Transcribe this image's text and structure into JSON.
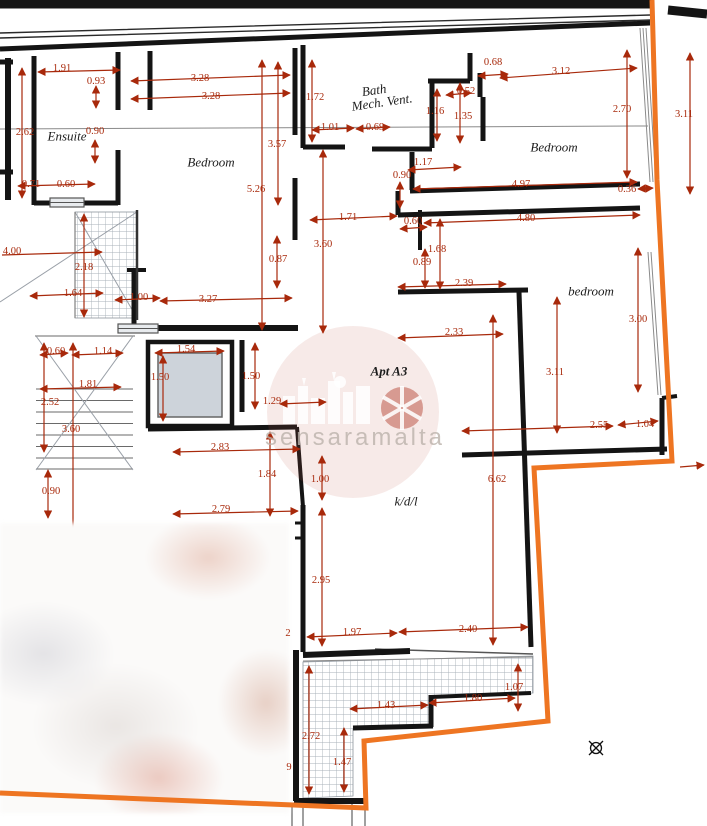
{
  "plan": {
    "apartment_label": "Apt A3",
    "watermark_text": "sensaramalta",
    "colors": {
      "dimension": "#a8290b",
      "boundary": "#ee7522",
      "wall": "#141414",
      "hatch": "#a9b0b8"
    }
  },
  "rooms": [
    {
      "id": "ensuite",
      "label": "Ensuite",
      "x": 67,
      "y": 136,
      "rot": 0
    },
    {
      "id": "bedroom-top-left",
      "label": "Bedroom",
      "x": 211,
      "y": 162,
      "rot": 0
    },
    {
      "id": "bath",
      "label": "Bath",
      "x": 374,
      "y": 90,
      "rot": -8
    },
    {
      "id": "bath-mech-vent",
      "label": "Mech. Vent.",
      "x": 382,
      "y": 102,
      "rot": -8
    },
    {
      "id": "bedroom-top-right",
      "label": "Bedroom",
      "x": 554,
      "y": 147,
      "rot": 0
    },
    {
      "id": "bedroom-right",
      "label": "bedroom",
      "x": 591,
      "y": 291,
      "rot": 0
    },
    {
      "id": "apartment",
      "label": "Apt A3",
      "x": 389,
      "y": 371,
      "rot": 0,
      "bold": true
    },
    {
      "id": "kdl",
      "label": "k/d/l",
      "x": 406,
      "y": 501,
      "rot": 0
    }
  ],
  "dimensions": [
    {
      "v": "1.91",
      "x": 62,
      "y": 69
    },
    {
      "v": "0.93",
      "x": 96,
      "y": 82
    },
    {
      "v": "2.62",
      "x": 25,
      "y": 133
    },
    {
      "v": "0.90",
      "x": 95,
      "y": 132
    },
    {
      "v": "0.71",
      "x": 31,
      "y": 185
    },
    {
      "v": "0.60",
      "x": 66,
      "y": 185
    },
    {
      "v": "4.00",
      "x": 12,
      "y": 252
    },
    {
      "v": "2.18",
      "x": 84,
      "y": 268
    },
    {
      "v": "1.64",
      "x": 73,
      "y": 294
    },
    {
      "v": "1.00",
      "x": 139,
      "y": 298
    },
    {
      "v": "3.27",
      "x": 208,
      "y": 300
    },
    {
      "v": "3.28",
      "x": 200,
      "y": 79
    },
    {
      "v": "3.28",
      "x": 211,
      "y": 97
    },
    {
      "v": "3.57",
      "x": 277,
      "y": 145
    },
    {
      "v": "5.26",
      "x": 256,
      "y": 190
    },
    {
      "v": "0.87",
      "x": 278,
      "y": 260
    },
    {
      "v": "1.71",
      "x": 348,
      "y": 218
    },
    {
      "v": "3.60",
      "x": 323,
      "y": 245
    },
    {
      "v": "1.72",
      "x": 315,
      "y": 98
    },
    {
      "v": "1.01",
      "x": 330,
      "y": 128
    },
    {
      "v": "0.69",
      "x": 375,
      "y": 128
    },
    {
      "v": "1.16",
      "x": 435,
      "y": 112
    },
    {
      "v": "1.35",
      "x": 463,
      "y": 117
    },
    {
      "v": "0.52",
      "x": 466,
      "y": 92
    },
    {
      "v": "0.68",
      "x": 493,
      "y": 63
    },
    {
      "v": "1.17",
      "x": 423,
      "y": 163
    },
    {
      "v": "0.90",
      "x": 402,
      "y": 176
    },
    {
      "v": "3.12",
      "x": 561,
      "y": 72
    },
    {
      "v": "2.70",
      "x": 622,
      "y": 110
    },
    {
      "v": "3.11",
      "x": 684,
      "y": 115
    },
    {
      "v": "4.97",
      "x": 521,
      "y": 185
    },
    {
      "v": "0.36",
      "x": 627,
      "y": 190
    },
    {
      "v": "4.80",
      "x": 526,
      "y": 219
    },
    {
      "v": "0.60",
      "x": 413,
      "y": 222
    },
    {
      "v": "1.68",
      "x": 437,
      "y": 250
    },
    {
      "v": "0.89",
      "x": 422,
      "y": 263
    },
    {
      "v": "2.39",
      "x": 464,
      "y": 284
    },
    {
      "v": "3.00",
      "x": 638,
      "y": 320
    },
    {
      "v": "2.33",
      "x": 454,
      "y": 333
    },
    {
      "v": "3.11",
      "x": 555,
      "y": 373
    },
    {
      "v": "2.55",
      "x": 599,
      "y": 426
    },
    {
      "v": "1.04",
      "x": 645,
      "y": 425
    },
    {
      "v": "6.62",
      "x": 497,
      "y": 480
    },
    {
      "v": "0.60",
      "x": 56,
      "y": 352
    },
    {
      "v": "1.14",
      "x": 103,
      "y": 352
    },
    {
      "v": "1.54",
      "x": 186,
      "y": 350
    },
    {
      "v": "1.81",
      "x": 88,
      "y": 385
    },
    {
      "v": "1.50",
      "x": 160,
      "y": 378
    },
    {
      "v": "1.50",
      "x": 251,
      "y": 377
    },
    {
      "v": "2.52",
      "x": 50,
      "y": 403
    },
    {
      "v": "1.29",
      "x": 272,
      "y": 402
    },
    {
      "v": "3.60",
      "x": 71,
      "y": 430
    },
    {
      "v": "2.83",
      "x": 220,
      "y": 448
    },
    {
      "v": "1.84",
      "x": 267,
      "y": 475
    },
    {
      "v": "0.90",
      "x": 51,
      "y": 492
    },
    {
      "v": "2.79",
      "x": 221,
      "y": 510
    },
    {
      "v": "1.00",
      "x": 320,
      "y": 480
    },
    {
      "v": "2.95",
      "x": 321,
      "y": 581
    },
    {
      "v": "1.97",
      "x": 352,
      "y": 633
    },
    {
      "v": "2.40",
      "x": 468,
      "y": 630
    },
    {
      "v": "2.72",
      "x": 311,
      "y": 737
    },
    {
      "v": "1.47",
      "x": 342,
      "y": 763
    },
    {
      "v": "1.43",
      "x": 386,
      "y": 706
    },
    {
      "v": "1.80",
      "x": 473,
      "y": 699
    },
    {
      "v": "1.07",
      "x": 514,
      "y": 688
    },
    {
      "v": "2",
      "x": 288,
      "y": 634
    },
    {
      "v": "9",
      "x": 289,
      "y": 768
    }
  ]
}
